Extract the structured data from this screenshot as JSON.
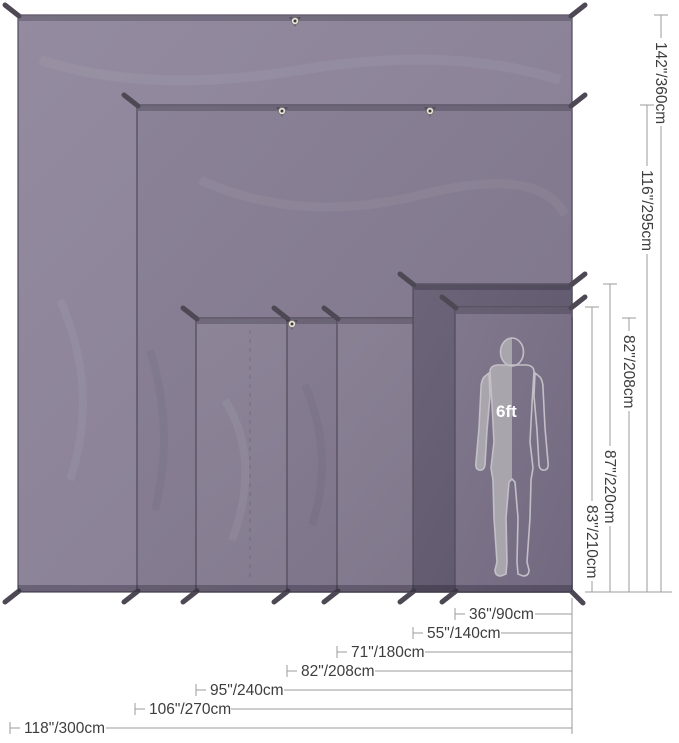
{
  "diagram": {
    "type": "tarp-size-comparison",
    "person": {
      "label": "6ft"
    },
    "dims": {
      "widths": [
        {
          "label": "36\"/90cm"
        },
        {
          "label": "55\"/140cm"
        },
        {
          "label": "71\"/180cm"
        },
        {
          "label": "82\"/208cm"
        },
        {
          "label": "95\"/240cm"
        },
        {
          "label": "106\"/270cm"
        },
        {
          "label": "118\"/300cm"
        }
      ],
      "heights": [
        {
          "label": "142\"/360cm"
        },
        {
          "label": "116\"/295cm"
        },
        {
          "label": "82\"/208cm"
        },
        {
          "label": "87\"/220cm"
        },
        {
          "label": "83\"/210cm"
        }
      ]
    },
    "sizes": [
      {
        "width": "118\"/300cm",
        "height": "142\"/360cm"
      },
      {
        "width": "106\"/270cm",
        "height": "116\"/295cm"
      },
      {
        "width": "95\"/240cm",
        "height": "82\"/208cm"
      },
      {
        "width": "82\"/208cm",
        "height": "82\"/208cm"
      },
      {
        "width": "71\"/180cm",
        "height": "82\"/208cm"
      },
      {
        "width": "55\"/140cm",
        "height": "87\"/220cm"
      },
      {
        "width": "36\"/90cm",
        "height": "83\"/210cm"
      }
    ],
    "colors": {
      "tarp_base": "#857c8f",
      "tarp_dark": "#655d70",
      "edge": "#4f4a5a",
      "dim_line": "#9b9b9b",
      "text": "#3d3d3d",
      "silhouette": "#a8a5ad",
      "background": "#ffffff"
    }
  }
}
